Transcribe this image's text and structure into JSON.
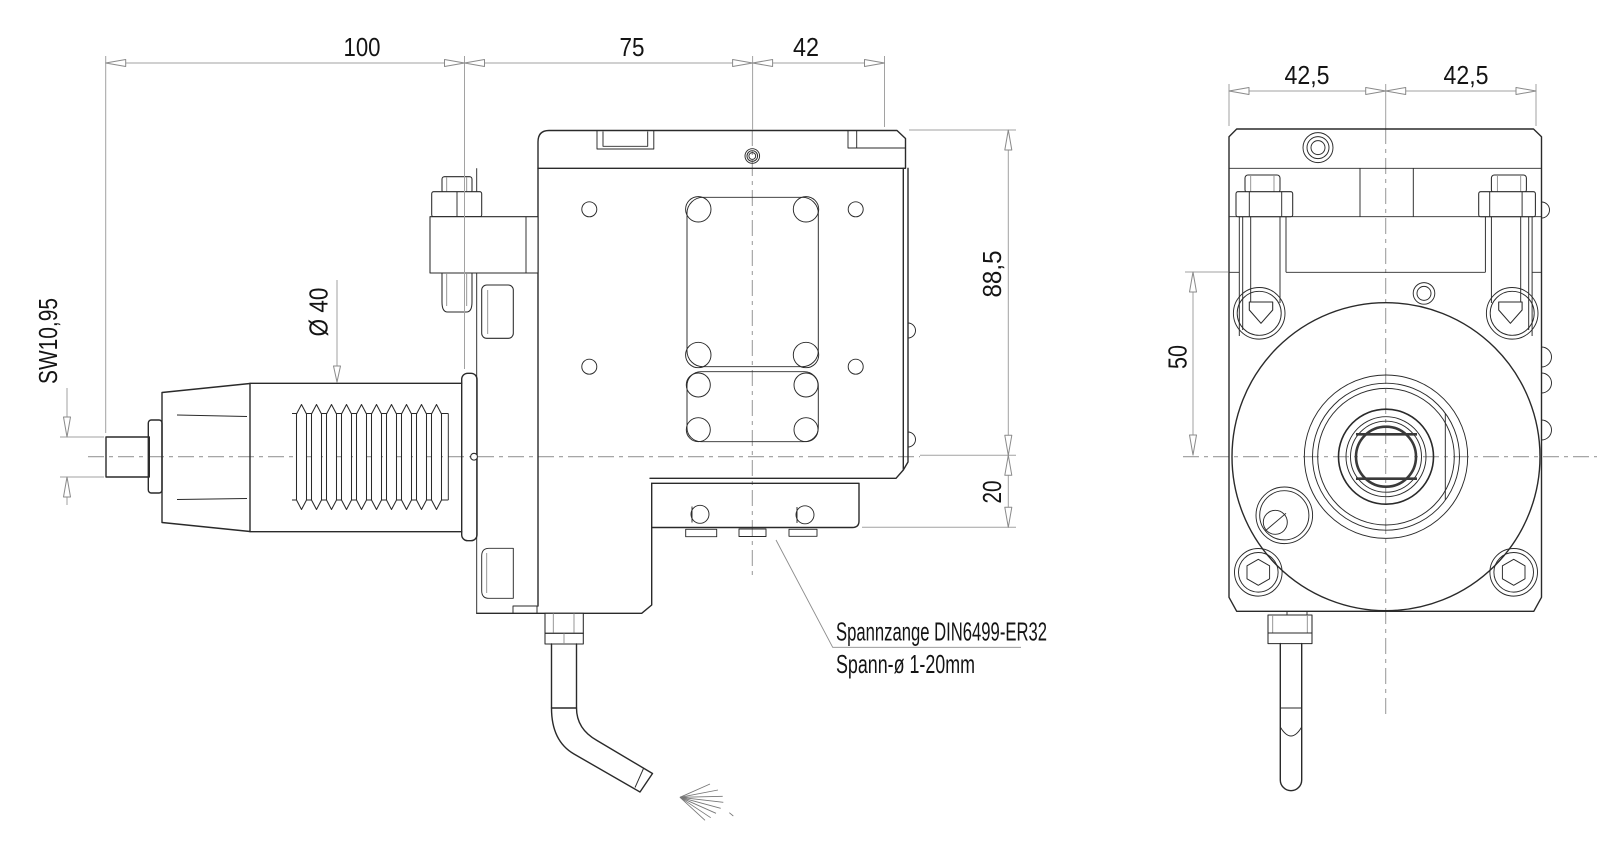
{
  "dimensions": {
    "width_100": "100",
    "width_75": "75",
    "width_42": "42",
    "height_88_5": "88,5",
    "height_20": "20",
    "front_left_42_5": "42,5",
    "front_right_42_5": "42,5",
    "front_50": "50",
    "wrench_size": "SW10,95",
    "diameter_40": "Ø 40"
  },
  "callout": {
    "line1": "Spannzange DIN6499-ER32",
    "line2": "Spann-ø 1-20mm"
  },
  "colors": {
    "line": "#2a2a2a",
    "dim": "#a2a2a2",
    "text": "#141414",
    "background": "#ffffff"
  }
}
